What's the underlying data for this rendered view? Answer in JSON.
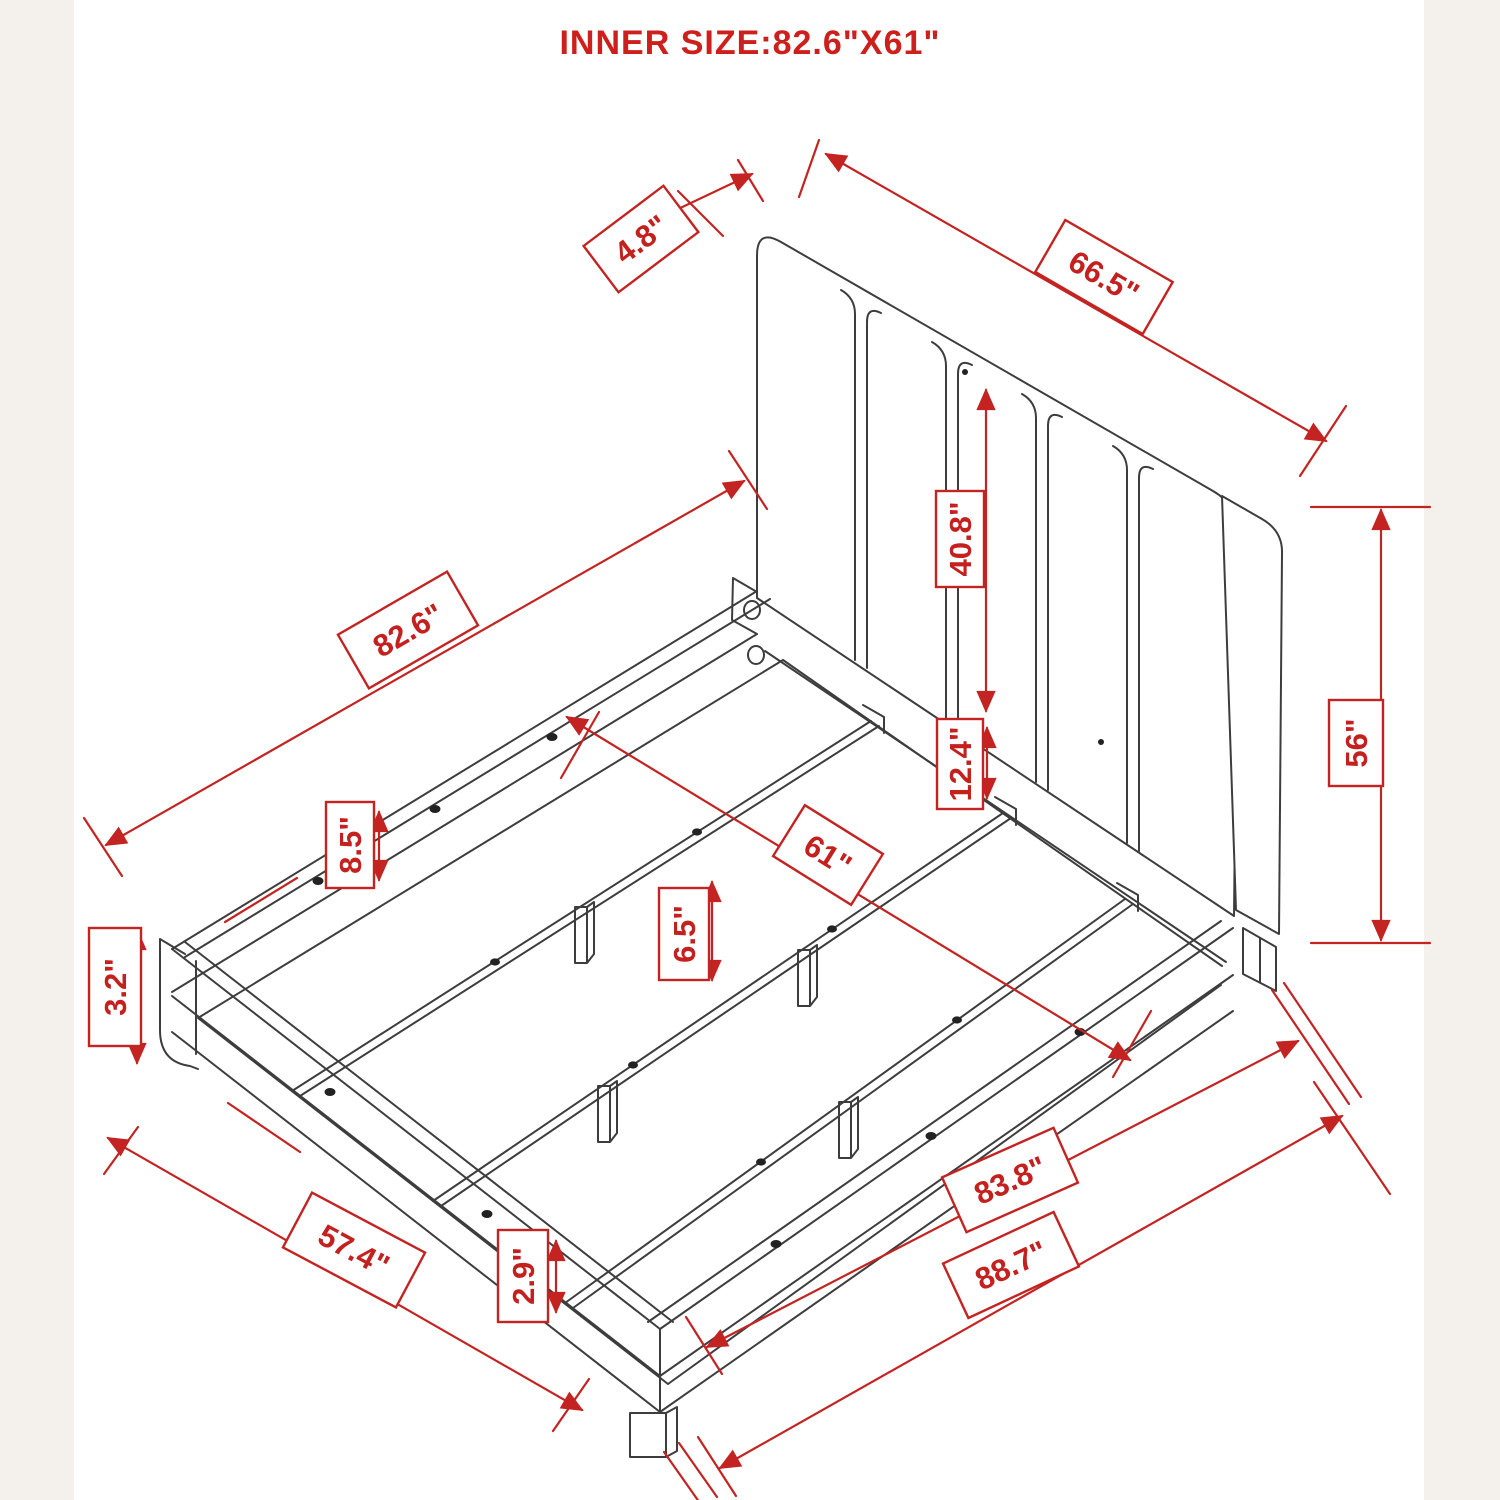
{
  "title": "INNER SIZE:82.6\"X61\"",
  "colors": {
    "dimension_red": "#c32422",
    "title_red": "#cd1f1c",
    "line_black": "#3d3d3d",
    "background": "#ffffff",
    "margin_strip": "#f4f0eb"
  },
  "dimensions": {
    "headboard_thickness": "4.8\"",
    "headboard_width": "66.5\"",
    "headboard_panel_height": "40.8\"",
    "headboard_lower_height": "12.4\"",
    "inner_length": "82.6\"",
    "side_rail_height": "8.5\"",
    "inner_width": "61\"",
    "center_leg_height": "6.5\"",
    "base_height": "3.2\"",
    "headboard_height": "56\"",
    "outer_length": "83.8\"",
    "total_length": "88.7\"",
    "foot_width": "57.4\"",
    "foot_leg_height": "2.9\""
  }
}
